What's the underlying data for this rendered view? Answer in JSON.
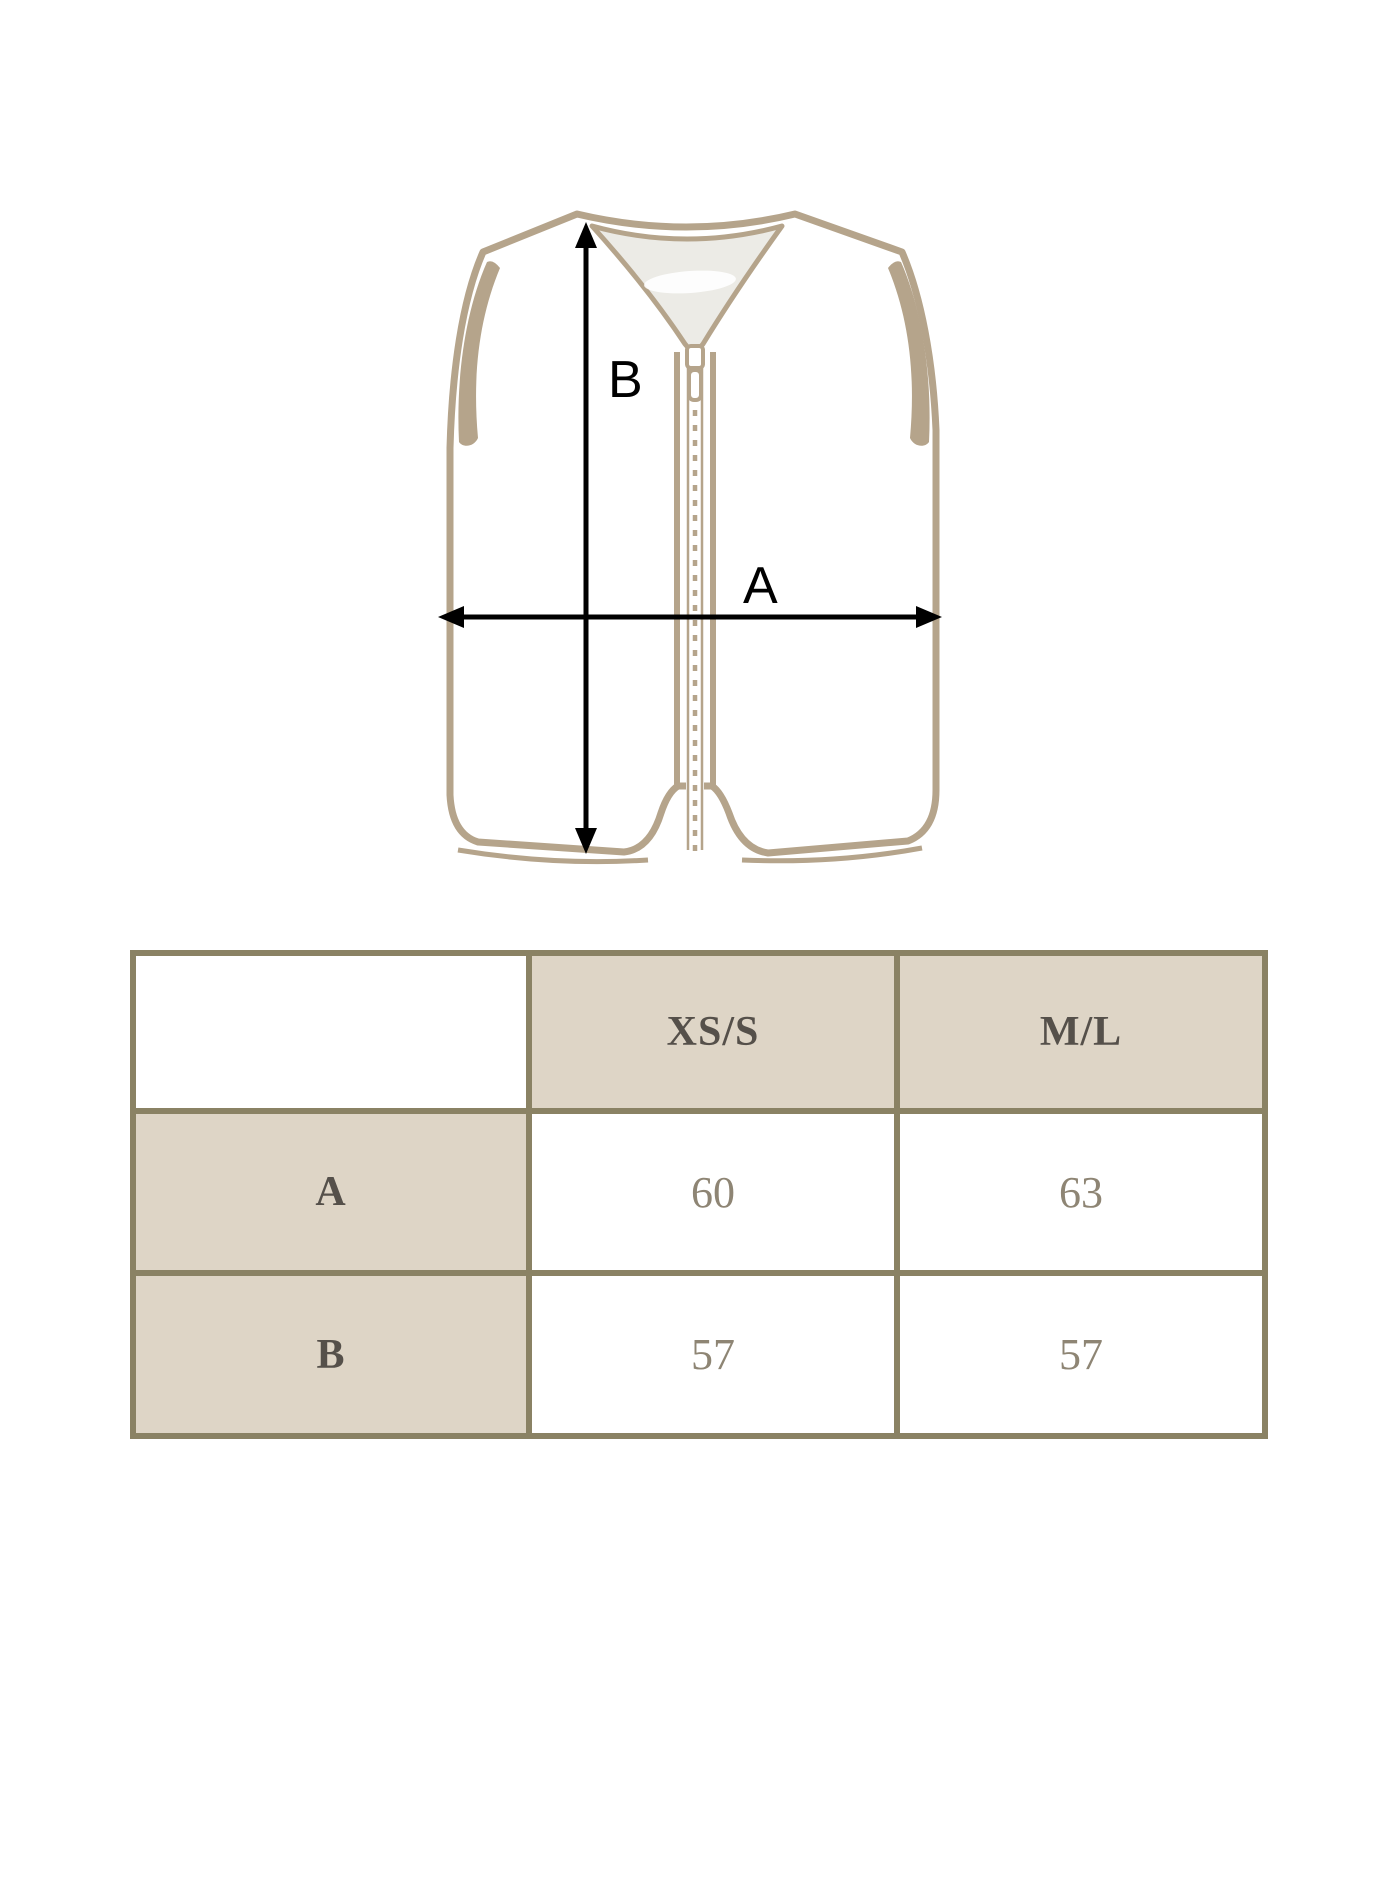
{
  "diagram": {
    "garment": "sleeveless zip vest illustration",
    "label_a": "A",
    "label_b": "B",
    "colors": {
      "outline_tan": "#b5a48b",
      "inner_neck_gray": "#ecebe6",
      "arrow_black": "#000000"
    }
  },
  "size_table": {
    "corner_label": "",
    "columns": [
      "XS/S",
      "M/L"
    ],
    "rows": [
      {
        "label": "A",
        "values": [
          "60",
          "63"
        ]
      },
      {
        "label": "B",
        "values": [
          "57",
          "57"
        ]
      }
    ],
    "colors": {
      "border": "#8a8264",
      "shaded_cell_bg": "#ded5c6",
      "plain_cell_bg": "#ffffff",
      "header_text": "#55504a",
      "value_text": "#8e8574"
    }
  }
}
